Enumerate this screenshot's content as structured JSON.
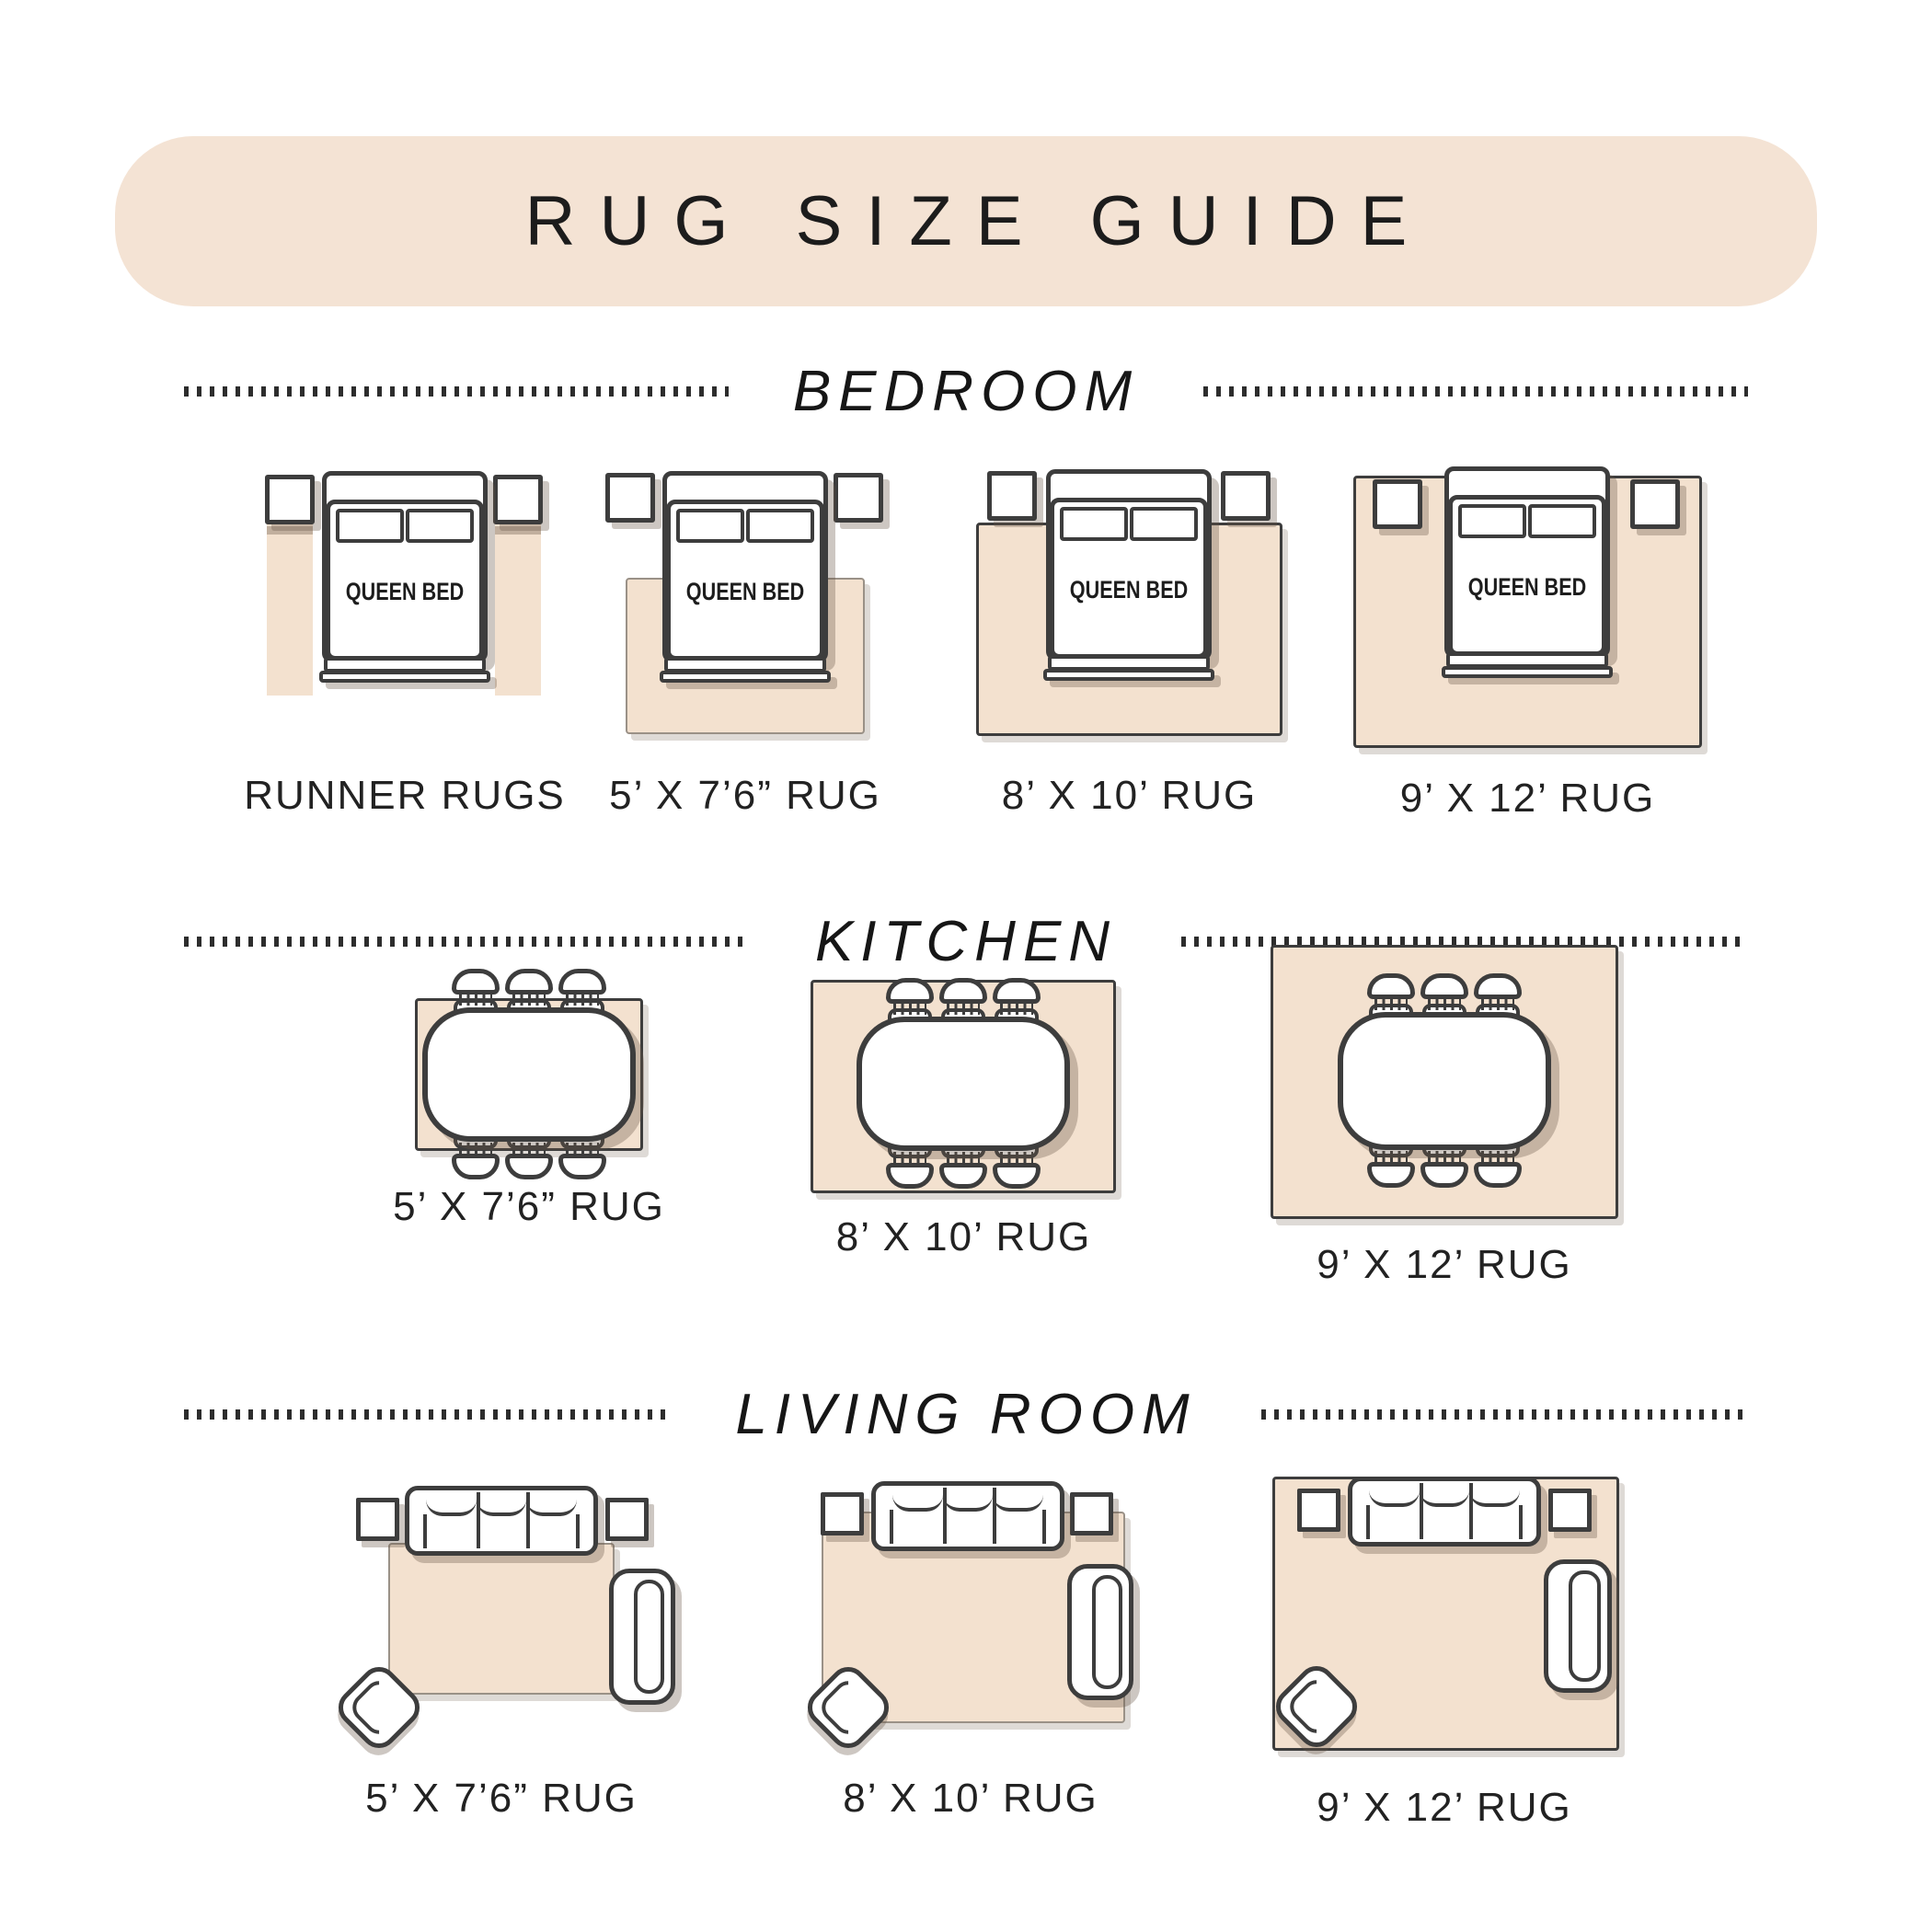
{
  "title": "RUG SIZE GUIDE",
  "sections": {
    "bedroom": {
      "heading": "BEDROOM",
      "bed_label": "QUEEN BED",
      "items": [
        {
          "label": "RUNNER RUGS"
        },
        {
          "label": "5’ X 7’6” RUG"
        },
        {
          "label": "8’ X 10’ RUG"
        },
        {
          "label": "9’ X 12’ RUG"
        }
      ]
    },
    "kitchen": {
      "heading": "KITCHEN",
      "items": [
        {
          "label": "5’ X 7’6” RUG"
        },
        {
          "label": "8’ X 10’ RUG"
        },
        {
          "label": "9’ X 12’ RUG"
        }
      ]
    },
    "living_room": {
      "heading": "LIVING ROOM",
      "items": [
        {
          "label": "5’ X 7’6” RUG"
        },
        {
          "label": "8’ X 10’ RUG"
        },
        {
          "label": "9’ X 12’ RUG"
        }
      ]
    }
  },
  "colors": {
    "banner": "#f4e3d4",
    "rug": "#f3e1cf",
    "outline": "#3d3d3d",
    "text": "#222222"
  }
}
